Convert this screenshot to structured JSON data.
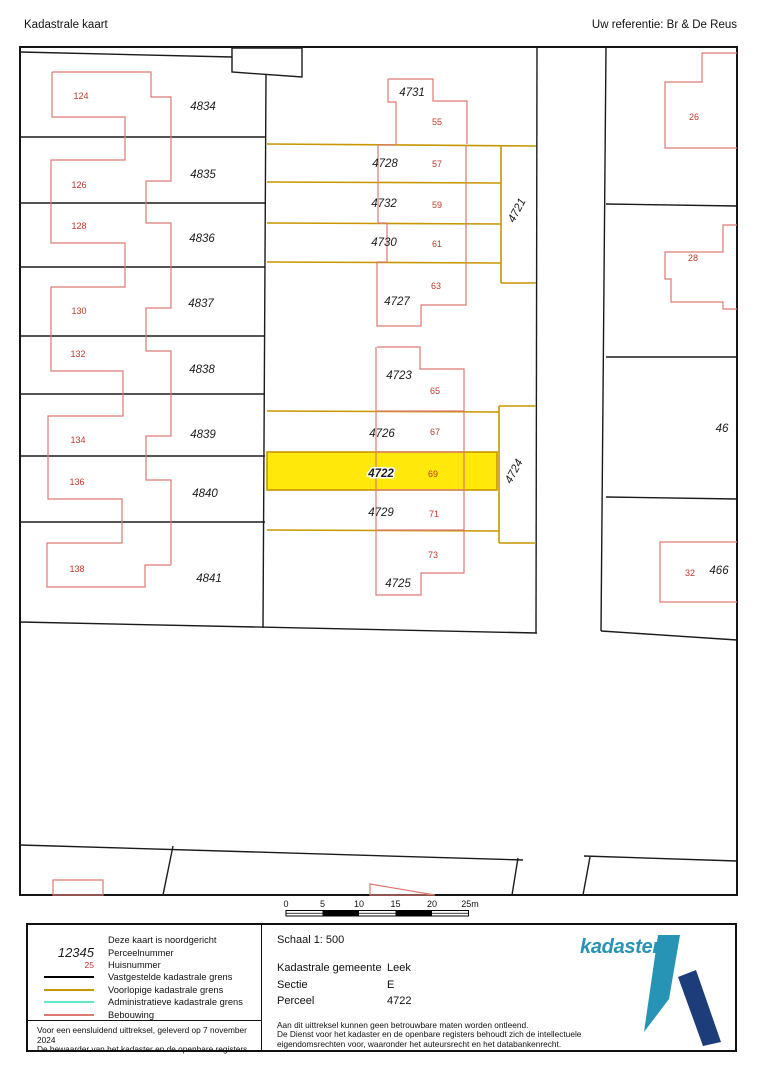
{
  "header": {
    "title": "Kadastrale kaart",
    "reference": "Uw referentie: Br & De Reus"
  },
  "map": {
    "parcel_labels": {
      "4834": "4834",
      "4835": "4835",
      "4836": "4836",
      "4837": "4837",
      "4838": "4838",
      "4839": "4839",
      "4840": "4840",
      "4841": "4841",
      "4731": "4731",
      "4728": "4728",
      "4732": "4732",
      "4730": "4730",
      "4727": "4727",
      "4723": "4723",
      "4726": "4726",
      "4722": "4722",
      "4729": "4729",
      "4725": "4725",
      "4721": "4721",
      "4724": "4724",
      "46": "46",
      "466": "466"
    },
    "house_numbers": {
      "124": "124",
      "126": "126",
      "128": "128",
      "130": "130",
      "132": "132",
      "134": "134",
      "136": "136",
      "138": "138",
      "55": "55",
      "57": "57",
      "59": "59",
      "61": "61",
      "63": "63",
      "65": "65",
      "67": "67",
      "69": "69",
      "71": "71",
      "73": "73",
      "26": "26",
      "28": "28",
      "32": "32"
    },
    "highlighted_parcel": "4722"
  },
  "scale_bar": {
    "ticks": [
      "0",
      "5",
      "10",
      "15",
      "20",
      "25m"
    ]
  },
  "legend": {
    "north_note": "Deze kaart is noordgericht",
    "parcel_sample": "12345",
    "parcel_label": "Perceelnummer",
    "house_sample": "25",
    "house_label": "Huisnummer",
    "line_black_label": "Vastgestelde kadastrale grens",
    "line_yellow_label": "Voorlopige kadastrale grens",
    "line_cyan_label": "Administratieve kadastrale grens",
    "line_red_label": "Bebouwing"
  },
  "info": {
    "scale": "Schaal 1: 500",
    "rows": [
      {
        "label": "Kadastrale gemeente",
        "value": "Leek"
      },
      {
        "label": "Sectie",
        "value": "E"
      },
      {
        "label": "Perceel",
        "value": "4722"
      }
    ]
  },
  "disclaimer": {
    "line1": "Aan dit uittreksel kunnen geen betrouwbare maten worden ontleend.",
    "line2": "De Dienst voor het kadaster en de openbare registers behoudt zich de intellectuele",
    "line3": "eigendomsrechten voor, waaronder het auteursrecht en het databankenrecht."
  },
  "attestation": {
    "line1": "Voor een eensluidend uittreksel, geleverd op 7 november 2024",
    "line2": "De bewaarder van het kadaster en de openbare registers"
  },
  "logo": {
    "wordmark": "kadaster"
  },
  "colors": {
    "highlight_fill": "#FFE80A",
    "provisional_boundary": "#C79600",
    "administrative_boundary": "#63E6C8",
    "building_outline": "#DD7A72",
    "house_number_text": "#C0392B",
    "logo_light_blue": "#2793B5",
    "logo_dark_blue": "#1D3D7A"
  }
}
